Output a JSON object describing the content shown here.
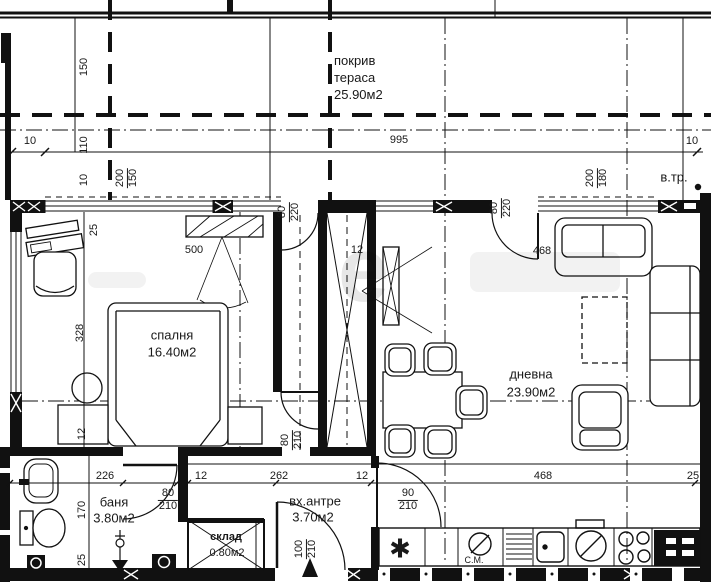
{
  "rooms": {
    "terrace": {
      "l1": "покрив",
      "l2": "тераса",
      "l3": "25.90м2"
    },
    "bedroom": {
      "name": "спалня",
      "area": "16.40м2"
    },
    "living": {
      "name": "дневна",
      "area": "23.90м2"
    },
    "bath": {
      "name": "баня",
      "area": "3.80м2"
    },
    "entry": {
      "name": "вх.антре",
      "area": "3.70м2"
    },
    "storage": {
      "name": "склад",
      "area": "0.80м2"
    }
  },
  "labels": {
    "vtr": "в.тр.",
    "cm": "С.М.",
    "star": "✱",
    "watermark": "е"
  },
  "dims": {
    "d150": "150",
    "d110": "110",
    "d10l": "10",
    "d995": "995",
    "d10r": "10",
    "d10ax": "10",
    "ax_left": {
      "a": "200",
      "b": "150"
    },
    "ax_right": {
      "a": "200",
      "b": "180"
    },
    "door_corr": {
      "a": "80",
      "b": "220"
    },
    "door_liv": {
      "a": "80",
      "b": "220"
    },
    "bed25": "25",
    "bed500": "500",
    "shaft12": "12",
    "top468": "468",
    "bed328": "328",
    "left12": "12",
    "r226": "226",
    "r12a": "12",
    "r262": "262",
    "r12b": "12",
    "r468": "468",
    "r25": "25",
    "door_bath": {
      "a": "80",
      "b": "210"
    },
    "door_hall": {
      "a": "90",
      "b": "210"
    },
    "door_entry": {
      "a": "100",
      "b": "210"
    },
    "door_bed": {
      "a": "80",
      "b": "210"
    },
    "b170": "170",
    "b25": "25"
  }
}
